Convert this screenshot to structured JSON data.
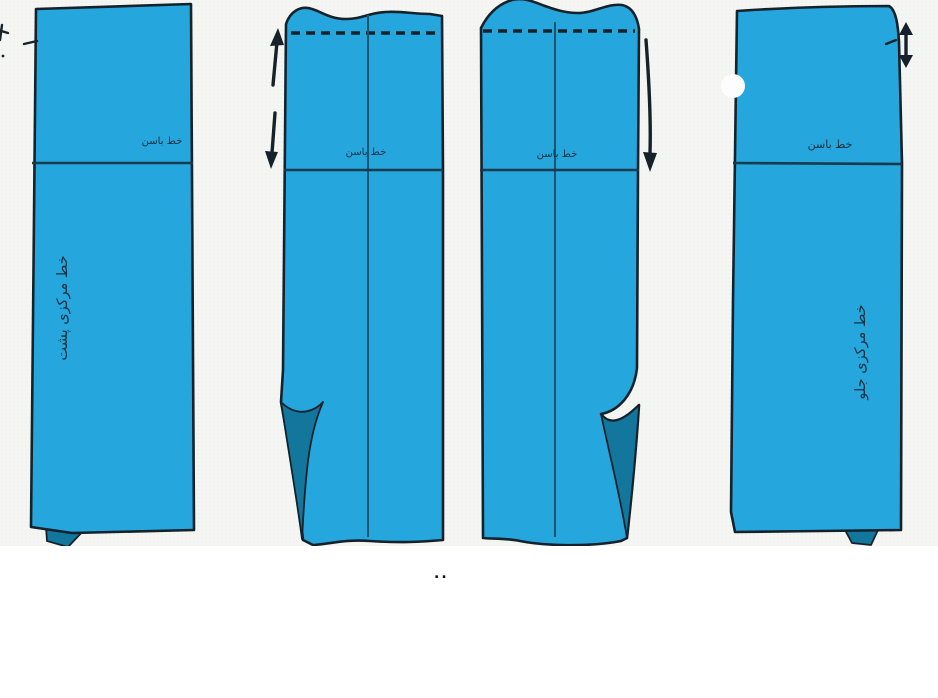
{
  "figure": {
    "type": "sewing-pattern-diagram",
    "panels": [
      {
        "id": "back-skirt-panel",
        "hip_label": "خط باسن",
        "center_label": "خط مرکزی پشت"
      },
      {
        "id": "back-half-panel-folded-hem",
        "hip_label": "خط باسن"
      },
      {
        "id": "front-half-panel-folded-hem",
        "hip_label": "خط باسن"
      },
      {
        "id": "front-skirt-panel",
        "hip_label": "خط باسن",
        "center_label": "خط مرکزی جلو"
      }
    ],
    "caption_mark": "..",
    "icons": [
      "up-arrow-icon",
      "down-arrow-icon",
      "long-down-arrow-icon",
      "double-vertical-arrow-icon"
    ]
  },
  "colors": {
    "panel_blue": "#25a7de",
    "fold_teal": "#13769c",
    "outline_dark": "#16222b",
    "hip_line": "#173a4f",
    "center_line": "#1d546f",
    "label_text": "#16303f",
    "canvas_bg": "#f5f6f2",
    "page_bg": "#ffffff",
    "notch_white": "#fdfdfd"
  }
}
